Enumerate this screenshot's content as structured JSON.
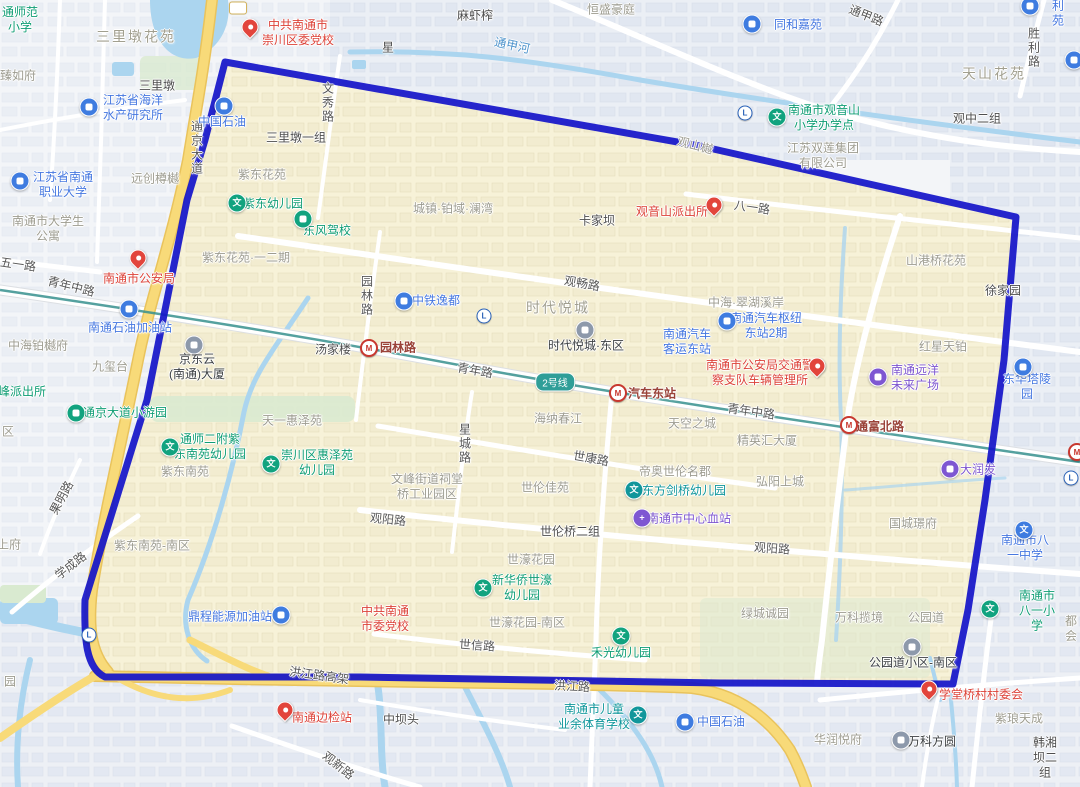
{
  "map": {
    "colors": {
      "boundary": "#1414c9",
      "region_fill": "#f7f2d8",
      "road_yellow": "#f8da79",
      "water": "#abd5ef",
      "metro_line": "#37918e",
      "badge_bg": "#2f9e98",
      "pin_red": "#e2453c",
      "poi_blue": "#3f7ce0",
      "poi_green": "#12a37f",
      "poi_teal": "#11969b",
      "poi_purple": "#7e57d2",
      "poi_gray": "#8d99ab"
    },
    "metro_badge": "2号线",
    "labels": [
      {
        "t": "通师范\n小学",
        "x": 20,
        "y": 20,
        "k": "poi-green"
      },
      {
        "t": "三里墩花苑",
        "x": 136,
        "y": 37,
        "k": "area-lg"
      },
      {
        "t": "臻如府",
        "x": 18,
        "y": 76,
        "k": "area"
      },
      {
        "t": "三里墩",
        "x": 157,
        "y": 86,
        "k": "town"
      },
      {
        "t": "江苏省海洋\n水产研究所",
        "x": 133,
        "y": 108,
        "k": "poi-blue"
      },
      {
        "t": "江苏省南通\n职业大学",
        "x": 63,
        "y": 185,
        "k": "poi-blue"
      },
      {
        "t": "远创樽樾",
        "x": 155,
        "y": 179,
        "k": "area"
      },
      {
        "t": "中共南通市\n崇川区委党校",
        "x": 298,
        "y": 33,
        "k": "poi-red"
      },
      {
        "t": "通甲路",
        "x": 866,
        "y": 16,
        "k": "road",
        "r": 22
      },
      {
        "t": "麻虾榨",
        "x": 475,
        "y": 16,
        "k": "town"
      },
      {
        "t": "恒盛豪庭",
        "x": 611,
        "y": 10,
        "k": "area"
      },
      {
        "t": "同和嘉苑",
        "x": 798,
        "y": 25,
        "k": "poi-blue"
      },
      {
        "t": "胜利苑",
        "x": 1058,
        "y": 6,
        "k": "poi-blue"
      },
      {
        "t": "天山花苑",
        "x": 994,
        "y": 74,
        "k": "area-lg"
      },
      {
        "t": "观中二组",
        "x": 977,
        "y": 119,
        "k": "town"
      },
      {
        "t": "胜利路",
        "x": 1033,
        "y": 48,
        "k": "road",
        "v": true
      },
      {
        "t": "通甲河",
        "x": 512,
        "y": 46,
        "k": "river",
        "r": 12
      },
      {
        "t": "星",
        "x": 388,
        "y": 48,
        "k": "town"
      },
      {
        "t": "南通市观音山\n小学办学点",
        "x": 824,
        "y": 118,
        "k": "poi-green"
      },
      {
        "t": "江苏双莲集团\n有限公司",
        "x": 823,
        "y": 156,
        "k": "area"
      },
      {
        "t": "观山樾",
        "x": 695,
        "y": 146,
        "k": "area",
        "r": 14
      },
      {
        "t": "通京大道",
        "x": 196,
        "y": 148,
        "k": "road",
        "v": true
      },
      {
        "t": "中国石油",
        "x": 222,
        "y": 122,
        "k": "poi-blue"
      },
      {
        "t": "三里墩一组",
        "x": 296,
        "y": 138,
        "k": "town"
      },
      {
        "t": "紫东花苑",
        "x": 262,
        "y": 175,
        "k": "area"
      },
      {
        "t": "文秀路",
        "x": 327,
        "y": 103,
        "k": "road",
        "v": true
      },
      {
        "t": "紫东幼儿园",
        "x": 273,
        "y": 204,
        "k": "poi-green"
      },
      {
        "t": "东风驾校",
        "x": 327,
        "y": 231,
        "k": "poi-green"
      },
      {
        "t": "紫东花苑·一二期",
        "x": 246,
        "y": 258,
        "k": "area"
      },
      {
        "t": "南通市大学生\n公寓",
        "x": 48,
        "y": 229,
        "k": "area"
      },
      {
        "t": "五一路",
        "x": 18,
        "y": 265,
        "k": "road",
        "r": 8
      },
      {
        "t": "青年中路",
        "x": 71,
        "y": 287,
        "k": "road",
        "r": 14
      },
      {
        "t": "南通市公安局",
        "x": 139,
        "y": 279,
        "k": "poi-red"
      },
      {
        "t": "南通石油加油站",
        "x": 130,
        "y": 328,
        "k": "poi-blue"
      },
      {
        "t": "中海铂樾府",
        "x": 38,
        "y": 346,
        "k": "area"
      },
      {
        "t": "九玺台",
        "x": 110,
        "y": 367,
        "k": "area"
      },
      {
        "t": "峰派出所",
        "x": 22,
        "y": 392,
        "k": "poi-green"
      },
      {
        "t": "京东云\n(南通)大厦",
        "x": 197,
        "y": 367,
        "k": "poi-gray"
      },
      {
        "t": "汤家楼",
        "x": 333,
        "y": 350,
        "k": "town"
      },
      {
        "t": "城镇·铂域·澜湾",
        "x": 453,
        "y": 209,
        "k": "area"
      },
      {
        "t": "卡家坝",
        "x": 597,
        "y": 221,
        "k": "town"
      },
      {
        "t": "观音山派出所",
        "x": 672,
        "y": 212,
        "k": "poi-red"
      },
      {
        "t": "八一路",
        "x": 752,
        "y": 208,
        "k": "road",
        "r": 8
      },
      {
        "t": "观畅路",
        "x": 582,
        "y": 284,
        "k": "road",
        "r": 10
      },
      {
        "t": "中铁逸都",
        "x": 436,
        "y": 301,
        "k": "poi-blue"
      },
      {
        "t": "时代悦城",
        "x": 558,
        "y": 308,
        "k": "area-lg"
      },
      {
        "t": "时代悦城·东区",
        "x": 586,
        "y": 346,
        "k": "poi-gray"
      },
      {
        "t": "南通汽车\n客运东站",
        "x": 687,
        "y": 342,
        "k": "poi-blue"
      },
      {
        "t": "园林路",
        "x": 366,
        "y": 296,
        "k": "road",
        "v": true
      },
      {
        "t": "园林路",
        "x": 398,
        "y": 348,
        "k": "station"
      },
      {
        "t": "青年路",
        "x": 475,
        "y": 371,
        "k": "road",
        "r": 10
      },
      {
        "t": "汽车东站",
        "x": 652,
        "y": 394,
        "k": "station"
      },
      {
        "t": "青年中路",
        "x": 751,
        "y": 412,
        "k": "road",
        "r": 8
      },
      {
        "t": "通富北路",
        "x": 880,
        "y": 427,
        "k": "station"
      },
      {
        "t": "南通市公安局交通警\n察支队车辆管理所",
        "x": 760,
        "y": 373,
        "k": "poi-red"
      },
      {
        "t": "中海·翠湖溪岸",
        "x": 746,
        "y": 303,
        "k": "area"
      },
      {
        "t": "南通汽车枢纽\n东站2期",
        "x": 766,
        "y": 326,
        "k": "poi-blue"
      },
      {
        "t": "山港桥花苑",
        "x": 936,
        "y": 261,
        "k": "area"
      },
      {
        "t": "徐家园",
        "x": 1003,
        "y": 291,
        "k": "town"
      },
      {
        "t": "红星天铂",
        "x": 943,
        "y": 347,
        "k": "area"
      },
      {
        "t": "南通远洋\n未来广场",
        "x": 915,
        "y": 378,
        "k": "poi-purple"
      },
      {
        "t": "东华塔陵园",
        "x": 1027,
        "y": 387,
        "k": "poi-blue"
      },
      {
        "t": "区",
        "x": 8,
        "y": 432,
        "k": "area"
      },
      {
        "t": "通京大道小游园",
        "x": 125,
        "y": 413,
        "k": "poi-green"
      },
      {
        "t": "天一惠泽苑",
        "x": 292,
        "y": 421,
        "k": "area"
      },
      {
        "t": "通师二附紫\n东南苑幼儿园",
        "x": 210,
        "y": 447,
        "k": "poi-green"
      },
      {
        "t": "崇川区惠泽苑\n幼儿园",
        "x": 317,
        "y": 463,
        "k": "poi-green"
      },
      {
        "t": "紫东南苑",
        "x": 185,
        "y": 472,
        "k": "area"
      },
      {
        "t": "果明路",
        "x": 62,
        "y": 498,
        "k": "road",
        "r": -62
      },
      {
        "t": "学成路",
        "x": 71,
        "y": 566,
        "k": "road",
        "r": -38
      },
      {
        "t": "上府",
        "x": 9,
        "y": 545,
        "k": "area"
      },
      {
        "t": "紫东南苑-南区",
        "x": 152,
        "y": 546,
        "k": "area"
      },
      {
        "t": "海纳春江",
        "x": 558,
        "y": 419,
        "k": "area"
      },
      {
        "t": "星城路",
        "x": 464,
        "y": 444,
        "k": "road",
        "v": true
      },
      {
        "t": "世康路",
        "x": 591,
        "y": 459,
        "k": "road",
        "r": 10
      },
      {
        "t": "文峰街道祠堂\n桥工业园区",
        "x": 427,
        "y": 487,
        "k": "area"
      },
      {
        "t": "世伦佳苑",
        "x": 545,
        "y": 488,
        "k": "area"
      },
      {
        "t": "观阳路",
        "x": 388,
        "y": 520,
        "k": "road",
        "r": 6
      },
      {
        "t": "世伦桥二组",
        "x": 570,
        "y": 532,
        "k": "town"
      },
      {
        "t": "世濠花园",
        "x": 531,
        "y": 560,
        "k": "area"
      },
      {
        "t": "新华侨世濠\n幼儿园",
        "x": 522,
        "y": 588,
        "k": "poi-green"
      },
      {
        "t": "帝奥世伦名郡",
        "x": 675,
        "y": 472,
        "k": "area"
      },
      {
        "t": "东方剑桥幼儿园",
        "x": 684,
        "y": 491,
        "k": "poi-teal"
      },
      {
        "t": "南通市中心血站",
        "x": 689,
        "y": 519,
        "k": "poi-purple"
      },
      {
        "t": "天空之城",
        "x": 692,
        "y": 424,
        "k": "area"
      },
      {
        "t": "精英汇大厦",
        "x": 767,
        "y": 441,
        "k": "area"
      },
      {
        "t": "弘阳上城",
        "x": 780,
        "y": 482,
        "k": "area"
      },
      {
        "t": "大润发",
        "x": 978,
        "y": 470,
        "k": "poi-purple"
      },
      {
        "t": "国城璟府",
        "x": 913,
        "y": 524,
        "k": "area"
      },
      {
        "t": "观阳路",
        "x": 772,
        "y": 549,
        "k": "road",
        "r": 4
      },
      {
        "t": "南通市八一中学",
        "x": 1025,
        "y": 548,
        "k": "poi-blue"
      },
      {
        "t": "绿城诚园",
        "x": 765,
        "y": 614,
        "k": "area"
      },
      {
        "t": "万科揽境",
        "x": 859,
        "y": 618,
        "k": "area"
      },
      {
        "t": "公园道",
        "x": 926,
        "y": 618,
        "k": "area"
      },
      {
        "t": "公园道小区-南区",
        "x": 913,
        "y": 663,
        "k": "poi-gray"
      },
      {
        "t": "南通市八一小学",
        "x": 1037,
        "y": 611,
        "k": "poi-green"
      },
      {
        "t": "都会",
        "x": 1071,
        "y": 629,
        "k": "area"
      },
      {
        "t": "学堂桥村村委会",
        "x": 981,
        "y": 695,
        "k": "poi-red"
      },
      {
        "t": "紫琅天成",
        "x": 1019,
        "y": 719,
        "k": "area"
      },
      {
        "t": "华润悦府",
        "x": 838,
        "y": 740,
        "k": "area"
      },
      {
        "t": "万科方圆",
        "x": 932,
        "y": 742,
        "k": "poi-gray"
      },
      {
        "t": "韩湘坝二组",
        "x": 1045,
        "y": 758,
        "k": "town"
      },
      {
        "t": "中国石油",
        "x": 721,
        "y": 722,
        "k": "poi-blue"
      },
      {
        "t": "南通市儿童\n业余体育学校",
        "x": 594,
        "y": 717,
        "k": "poi-teal"
      },
      {
        "t": "中坝头",
        "x": 401,
        "y": 720,
        "k": "town"
      },
      {
        "t": "禾光幼儿园",
        "x": 621,
        "y": 653,
        "k": "poi-green"
      },
      {
        "t": "世濠花园-南区",
        "x": 527,
        "y": 623,
        "k": "area"
      },
      {
        "t": "世信路",
        "x": 477,
        "y": 646,
        "k": "road",
        "r": 4
      },
      {
        "t": "中共南通\n市委党校",
        "x": 385,
        "y": 619,
        "k": "poi-red"
      },
      {
        "t": "鼎程能源加油站",
        "x": 230,
        "y": 617,
        "k": "poi-blue"
      },
      {
        "t": "洪江路高架",
        "x": 319,
        "y": 676,
        "k": "road",
        "r": 8
      },
      {
        "t": "洪江路",
        "x": 572,
        "y": 687,
        "k": "road",
        "r": 3
      },
      {
        "t": "南通边检站",
        "x": 322,
        "y": 718,
        "k": "poi-red"
      },
      {
        "t": "观新路",
        "x": 338,
        "y": 766,
        "k": "road",
        "r": 38
      },
      {
        "t": "园",
        "x": 10,
        "y": 682,
        "k": "area"
      }
    ],
    "icons": [
      {
        "n": "party-school-pin-icon",
        "t": "pin",
        "x": 250,
        "y": 33,
        "c": "#e2453c"
      },
      {
        "n": "police-bureau-pin-icon",
        "t": "pin",
        "x": 138,
        "y": 264,
        "c": "#e2453c"
      },
      {
        "n": "police-station-pin-icon",
        "t": "pin",
        "x": 714,
        "y": 211,
        "c": "#e2453c"
      },
      {
        "n": "vehicle-admin-pin-icon",
        "t": "pin",
        "x": 817,
        "y": 372,
        "c": "#e2453c"
      },
      {
        "n": "village-committee-pin-icon",
        "t": "pin",
        "x": 929,
        "y": 695,
        "c": "#e2453c"
      },
      {
        "n": "border-checkpoint-pin-icon",
        "t": "pin",
        "x": 285,
        "y": 716,
        "c": "#e2453c"
      },
      {
        "n": "research-institute-icon",
        "t": "circ",
        "x": 89,
        "y": 107,
        "c": "#3f7ce0"
      },
      {
        "n": "university-icon",
        "t": "circ",
        "x": 20,
        "y": 181,
        "c": "#3f7ce0"
      },
      {
        "n": "residence-poi-icon",
        "t": "circ",
        "x": 752,
        "y": 24,
        "c": "#3f7ce0"
      },
      {
        "n": "residence-poi-icon",
        "t": "circ",
        "x": 1030,
        "y": 6,
        "c": "#3f7ce0"
      },
      {
        "n": "gas-station-icon",
        "t": "circ",
        "x": 224,
        "y": 106,
        "c": "#3f7ce0"
      },
      {
        "n": "real-estate-icon",
        "t": "circ",
        "x": 404,
        "y": 301,
        "c": "#3f7ce0"
      },
      {
        "n": "bus-hub-icon",
        "t": "circ",
        "x": 727,
        "y": 321,
        "c": "#3f7ce0"
      },
      {
        "n": "cemetery-icon",
        "t": "circ",
        "x": 1023,
        "y": 367,
        "c": "#3f7ce0"
      },
      {
        "n": "gas-station-icon",
        "t": "circ",
        "x": 685,
        "y": 722,
        "c": "#3f7ce0"
      },
      {
        "n": "gas-station-icon",
        "t": "circ",
        "x": 281,
        "y": 615,
        "c": "#3f7ce0"
      },
      {
        "n": "gas-station-icon",
        "t": "circ",
        "x": 129,
        "y": 309,
        "c": "#3f7ce0"
      },
      {
        "n": "clipped-poi-icon",
        "t": "circ",
        "x": 1074,
        "y": 60,
        "c": "#3f7ce0"
      },
      {
        "n": "school-icon",
        "t": "circ",
        "x": 777,
        "y": 117,
        "c": "#12a37f",
        "g": "文"
      },
      {
        "n": "kindergarten-icon",
        "t": "circ",
        "x": 237,
        "y": 203,
        "c": "#12a37f",
        "g": "文"
      },
      {
        "n": "driving-school-icon",
        "t": "circ",
        "x": 303,
        "y": 219,
        "c": "#12a37f"
      },
      {
        "n": "park-icon",
        "t": "circ",
        "x": 76,
        "y": 413,
        "c": "#12a37f"
      },
      {
        "n": "kindergarten-icon",
        "t": "circ",
        "x": 170,
        "y": 447,
        "c": "#12a37f",
        "g": "文"
      },
      {
        "n": "kindergarten-icon",
        "t": "circ",
        "x": 271,
        "y": 464,
        "c": "#12a37f",
        "g": "文"
      },
      {
        "n": "kindergarten-icon",
        "t": "circ",
        "x": 483,
        "y": 588,
        "c": "#12a37f",
        "g": "文"
      },
      {
        "n": "kindergarten-icon",
        "t": "circ",
        "x": 621,
        "y": 636,
        "c": "#12a37f",
        "g": "文"
      },
      {
        "n": "primary-school-icon",
        "t": "circ",
        "x": 990,
        "y": 609,
        "c": "#12a37f",
        "g": "文"
      },
      {
        "n": "kindergarten-icon",
        "t": "circ",
        "x": 634,
        "y": 490,
        "c": "#11969b",
        "g": "文"
      },
      {
        "n": "sports-school-icon",
        "t": "circ",
        "x": 638,
        "y": 715,
        "c": "#11969b",
        "g": "文"
      },
      {
        "n": "shopping-mall-icon",
        "t": "circ",
        "x": 878,
        "y": 377,
        "c": "#7e57d2"
      },
      {
        "n": "supermarket-icon",
        "t": "circ",
        "x": 950,
        "y": 469,
        "c": "#7e57d2"
      },
      {
        "n": "blood-center-icon",
        "t": "circ",
        "x": 642,
        "y": 518,
        "c": "#7e57d2",
        "g": "+"
      },
      {
        "n": "office-building-icon",
        "t": "circ",
        "x": 194,
        "y": 345,
        "c": "#8d99ab"
      },
      {
        "n": "residence-building-icon",
        "t": "circ",
        "x": 585,
        "y": 330,
        "c": "#8d99ab"
      },
      {
        "n": "residence-building-icon",
        "t": "circ",
        "x": 912,
        "y": 647,
        "c": "#8d99ab"
      },
      {
        "n": "residence-building-icon",
        "t": "circ",
        "x": 901,
        "y": 740,
        "c": "#8d99ab"
      },
      {
        "n": "middle-school-icon",
        "t": "circ",
        "x": 1024,
        "y": 530,
        "c": "#3f7ce0",
        "g": "文"
      },
      {
        "n": "metro-logo-icon",
        "t": "mlogo",
        "x": 745,
        "y": 113
      },
      {
        "n": "metro-logo-icon",
        "t": "mlogo",
        "x": 484,
        "y": 316
      },
      {
        "n": "metro-logo-icon",
        "t": "mlogo",
        "x": 89,
        "y": 635
      },
      {
        "n": "metro-logo-icon",
        "t": "mlogo",
        "x": 1071,
        "y": 478
      },
      {
        "n": "metro-station-icon",
        "t": "mstation",
        "x": 369,
        "y": 348
      },
      {
        "n": "metro-station-icon",
        "t": "mstation",
        "x": 618,
        "y": 393
      },
      {
        "n": "metro-station-icon",
        "t": "mstation",
        "x": 849,
        "y": 425
      },
      {
        "n": "metro-station-icon",
        "t": "mstation",
        "x": 1077,
        "y": 452
      },
      {
        "n": "road-shield-icon",
        "t": "shield",
        "x": 238,
        "y": 8
      }
    ]
  }
}
